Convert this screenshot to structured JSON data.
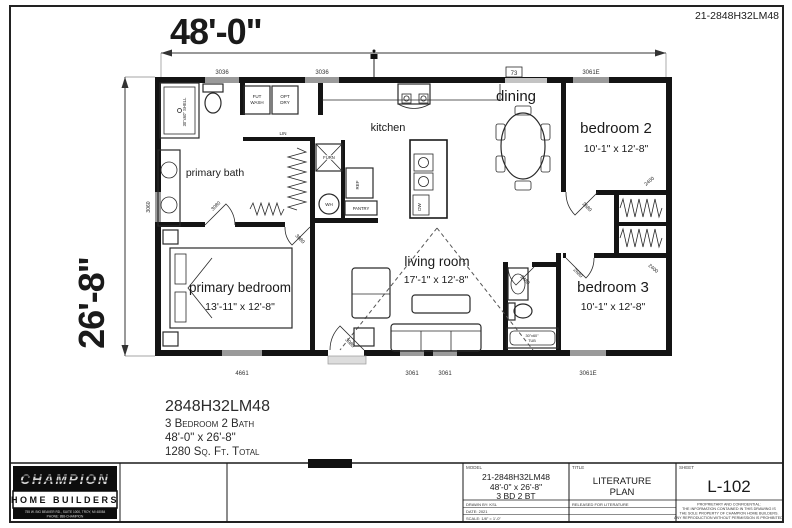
{
  "sheet_code": "21-2848H32LM48",
  "dimensions": {
    "width": "48'-0\"",
    "depth": "26'-8\""
  },
  "rooms": {
    "primary_bath": "primary bath",
    "kitchen": "kitchen",
    "dining": "dining",
    "living_room": "living room",
    "living_room_size": "17'-1\" x 12'-8\"",
    "primary_bedroom": "primary bedroom",
    "primary_bedroom_size": "13'-11\" x 12'-8\"",
    "bedroom2": "bedroom 2",
    "bedroom2_size": "10'-1\" x 12'-8\"",
    "bedroom3": "bedroom 3",
    "bedroom3_size": "10'-1\" x 12'-8\""
  },
  "fixtures": {
    "shower": "30\"x60\" SHELL",
    "washer_line1": "FUT",
    "washer_line2": "WASH",
    "dryer_line1": "OPT",
    "dryer_line2": "DRY",
    "linen": "LIN",
    "furnace": "FURN",
    "water_heater": "WH",
    "refrigerator": "REF",
    "pantry": "PANTRY",
    "dishwasher": "DW",
    "tub_line1": "30\"x60\"",
    "tub_line2": "TUB"
  },
  "window_tags": {
    "top_left": "3036",
    "top_mid": "3036",
    "dining": "73",
    "top_right": "3061E",
    "bottom_left": "4661",
    "bottom_mid1": "3061",
    "bottom_mid2": "3061",
    "bottom_right": "3061E",
    "left_wall": "3060"
  },
  "door_tags": {
    "primary_bath": "3080",
    "primary_bedroom": "3080",
    "front": "3080",
    "bedroom2": "2680",
    "bedroom3": "2680",
    "bath2": "2480",
    "closet_top": "2400",
    "closet_bottom": "2400"
  },
  "summary": {
    "model": "2848H32LM48",
    "config": "3 Bedroom 2 Bath",
    "size": "48'-0\" x 26'-8\"",
    "area": "1280 Sq. Ft. Total"
  },
  "title_block": {
    "brand_name": "CHAMPION",
    "brand_sub": "HOME BUILDERS",
    "brand_address1": "755 W. BIG BEAVER RD., SUITE 1000, TROY, MI 48084",
    "brand_address2": "PHONE: 888-CHAMPION",
    "model_header": "MODEL",
    "model_line1": "21-2848H32LM48",
    "model_line2": "48'-0\" x 26'-8\"",
    "model_line3": "3 BD 2 BT",
    "row_drawn": "DRAWN BY: KSL",
    "row_date": "DATE: 2021",
    "row_scale": "SCALE: 1/8\" = 1'-0\"",
    "title_header": "TITLE",
    "title_line1": "LITERATURE",
    "title_line2": "PLAN",
    "title_row": "RELEASED FOR LITERATURE",
    "sheet_header": "SHEET",
    "sheet_number": "L-102",
    "disclaimer1": "PROPRIETARY AND CONFIDENTIAL:",
    "disclaimer2": "THE INFORMATION CONTAINED IN THIS DRAWING IS",
    "disclaimer3": "THE SOLE PROPERTY OF CHAMPION HOME BUILDERS.",
    "disclaimer4": "ANY REPRODUCTION WITHOUT PERMISSION IS PROHIBITED."
  }
}
